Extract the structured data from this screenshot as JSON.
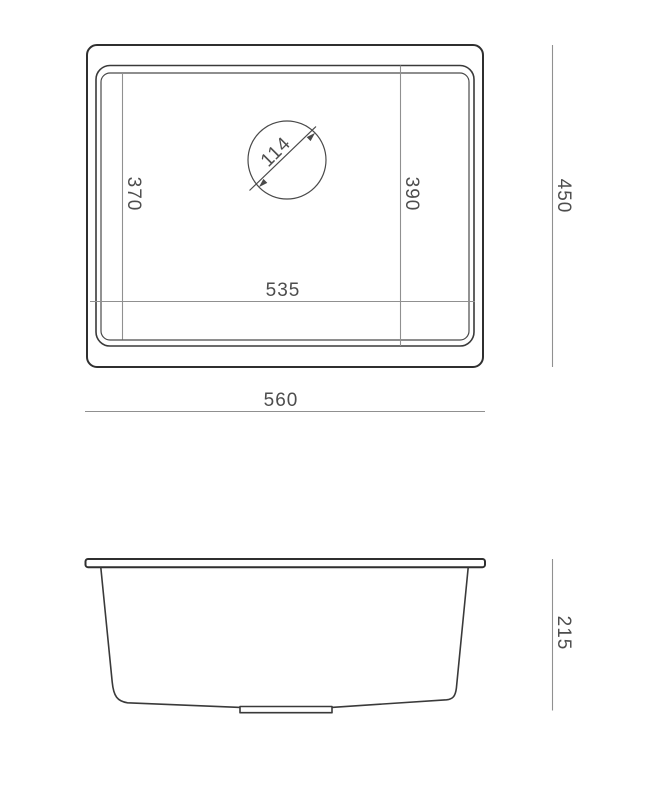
{
  "drawing": {
    "kind": "technical-drawing",
    "subject": "undermount-sink-dimensioned-views",
    "units": "mm",
    "colors": {
      "background": "#ffffff",
      "object_line_heavy": "#2f2f2f",
      "object_line_thin": "#4a4a4a",
      "dimension_line": "#909090",
      "label_text": "#4d4d4d"
    },
    "top_view": {
      "name": "plan view",
      "labels": {
        "inner_bottom_depth": "370",
        "bowl_depth": "390",
        "overall_depth": "450",
        "bowl_width": "535",
        "overall_width": "560",
        "drain_diameter": "114"
      }
    },
    "side_view": {
      "name": "front elevation",
      "labels": {
        "overall_height": "215"
      }
    }
  }
}
